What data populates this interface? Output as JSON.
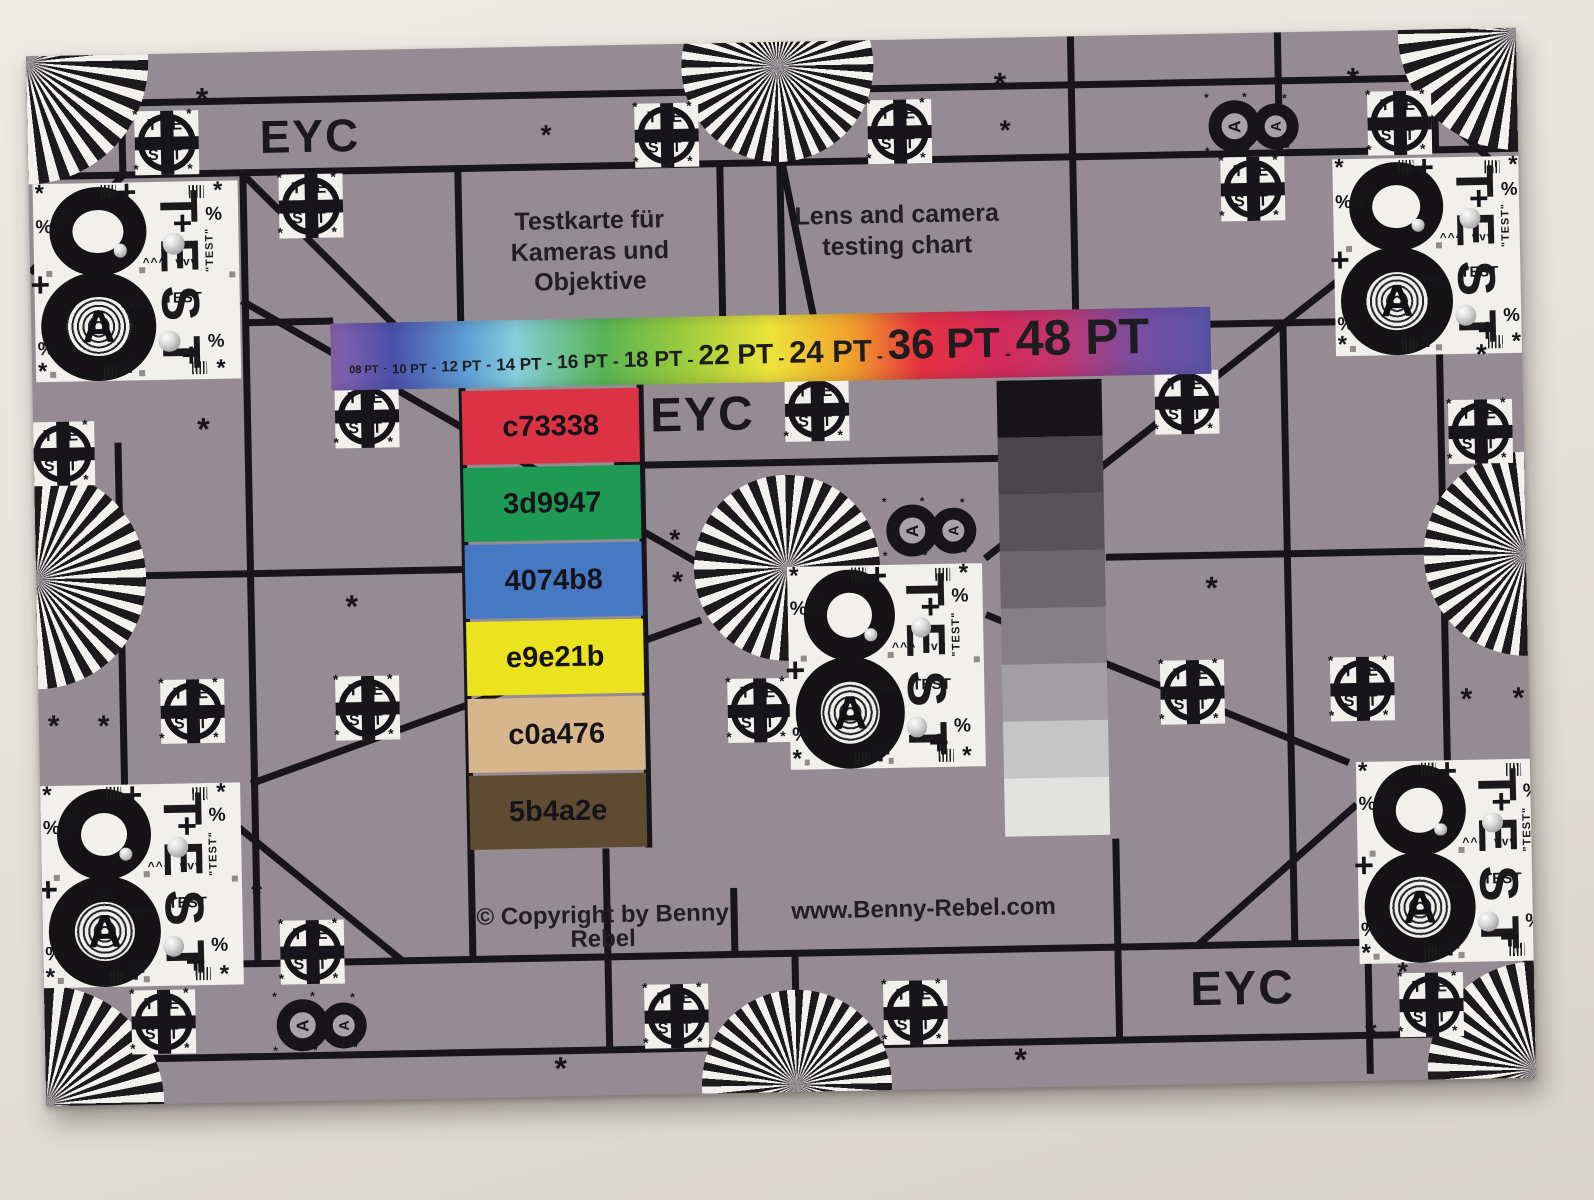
{
  "photo": {
    "background_top": "#EDEBE4",
    "background_bottom": "#D8D4CA"
  },
  "card": {
    "background_color": "#948C92",
    "grid_line_color": "#17151A",
    "patch_white_color": "#F1F0EC",
    "eyc_top_left": "EYC",
    "eyc_center": "EYC",
    "eyc_bottom_right": "EYC",
    "title_german_line1": "Testkarte für",
    "title_german_line2": "Kameras und Objektive",
    "title_english_line1": "Lens and camera",
    "title_english_line2": "testing chart",
    "copyright": "© Copyright by Benny Rebel",
    "website": "www.Benny-Rebel.com",
    "font_size_bar": {
      "labels": [
        "08 PT",
        "10 PT",
        "12 PT",
        "14 PT",
        "16 PT",
        "18 PT",
        "22 PT",
        "24 PT",
        "36 PT",
        "48 PT"
      ],
      "separator": "-",
      "gradient_stops": [
        "#8A63B0 0%",
        "#4B4FA9 7%",
        "#5C9AD4 15%",
        "#86CEDC 21%",
        "#57B554 31%",
        "#9BCB3C 40%",
        "#EDE43A 50%",
        "#F0A22B 59%",
        "#E63240 67%",
        "#D42A5B 76%",
        "#C2356E 83%",
        "#7A4D9E 91%",
        "#5B55AC 100%"
      ]
    },
    "color_patches": [
      {
        "hex_label": "c73338",
        "fill": "#DB3343"
      },
      {
        "hex_label": "3d9947",
        "fill": "#1E9A55"
      },
      {
        "hex_label": "4074b8",
        "fill": "#4579C4"
      },
      {
        "hex_label": "e9e21b",
        "fill": "#EBE31E"
      },
      {
        "hex_label": "c0a476",
        "fill": "#D8B68C"
      },
      {
        "hex_label": "5b4a2e",
        "fill": "#5E4B31"
      }
    ],
    "grayscale_steps": [
      "#171417",
      "#49454A",
      "#575358",
      "#6B676C",
      "#837F84",
      "#A29FA3",
      "#C6C5C6",
      "#E2E2E0"
    ],
    "test_circle_logo": {
      "letters": [
        "T",
        "E",
        "S",
        "T"
      ],
      "asterisk": "*"
    },
    "test8_block": {
      "numeral": "8",
      "letter_a": "A",
      "vertical_text": "TEST",
      "small_text": "TEST",
      "side_text": "\"TEST\"",
      "chevrons_up": "^^^",
      "chevrons_down": "vvv",
      "arrows": "<<<",
      "percent": "%",
      "plus": "+",
      "asterisk": "*",
      "hole_noise_lines": [
        "≣⁺∥≡",
        "✱<<<",
        "%∥⁺"
      ]
    },
    "mini8_block": {
      "letter_a": "A",
      "asterisk": "*"
    }
  }
}
